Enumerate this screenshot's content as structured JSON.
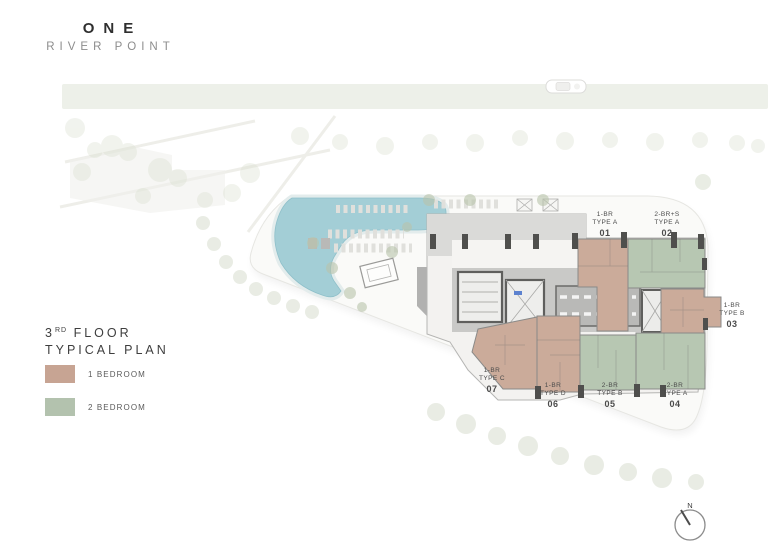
{
  "logo": {
    "name": "ONE",
    "subtitle": "RIVER POINT"
  },
  "plan_title": {
    "floor": "3",
    "floor_ordinal": "RD",
    "floor_word": "FLOOR",
    "subtitle": "TYPICAL PLAN"
  },
  "legend": {
    "items": [
      {
        "label": "1 BEDROOM",
        "color": "#c7a493"
      },
      {
        "label": "2 BEDROOM",
        "color": "#b3c2ae"
      }
    ]
  },
  "units": [
    {
      "bed": "1-BR",
      "type": "TYPE A",
      "number": "01",
      "category": "1 BEDROOM"
    },
    {
      "bed": "2-BR+S",
      "type": "TYPE A",
      "number": "02",
      "category": "2 BEDROOM"
    },
    {
      "bed": "1-BR",
      "type": "TYPE B",
      "number": "03",
      "category": "1 BEDROOM"
    },
    {
      "bed": "2-BR",
      "type": "TYPE A",
      "number": "04",
      "category": "2 BEDROOM"
    },
    {
      "bed": "2-BR",
      "type": "TYPE B",
      "number": "05",
      "category": "2 BEDROOM"
    },
    {
      "bed": "1-BR",
      "type": "TYPE D",
      "number": "06",
      "category": "1 BEDROOM"
    },
    {
      "bed": "1-BR",
      "type": "TYPE C",
      "number": "07",
      "category": "1 BEDROOM"
    }
  ],
  "compass": {
    "north_label": "N"
  },
  "colors": {
    "one_bedroom": "#cbab9a",
    "two_bedroom": "#b7c7b2",
    "pool": "#a3ced6",
    "site": "#fafaf8",
    "river": "#edf0e9",
    "core": "#c9c9c7",
    "driveway": "#a9a9a7",
    "terrace": "#dadad8"
  }
}
